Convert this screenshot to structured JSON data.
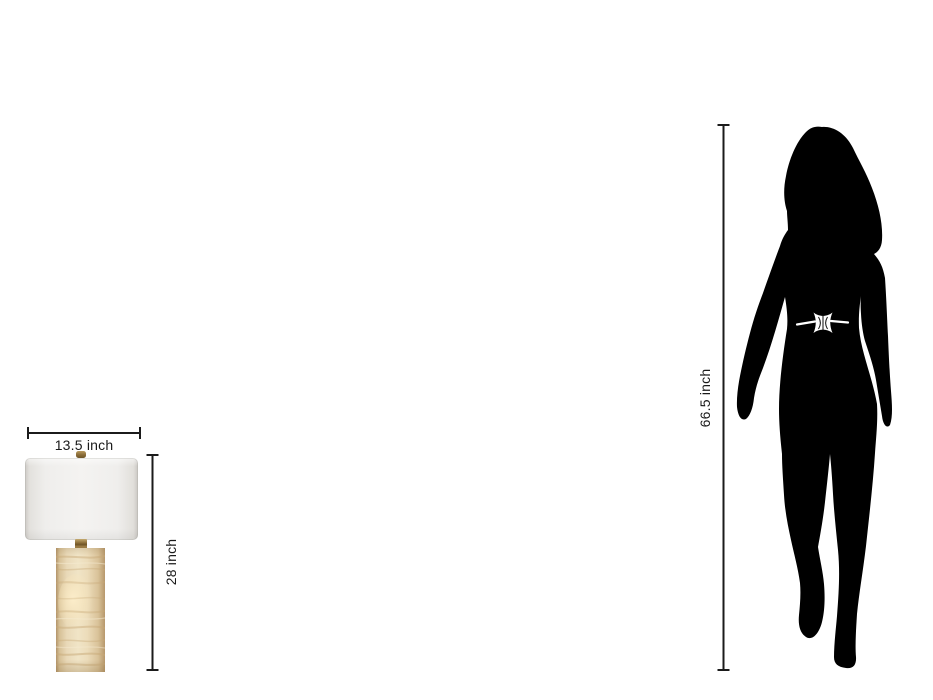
{
  "page": {
    "background_color": "#ffffff",
    "description_labels_only": true
  },
  "lamp": {
    "width_dimension": {
      "label": "13.5 inch"
    },
    "height_dimension": {
      "label": "28 inch"
    },
    "colors": {
      "shade": "#f2f1ef",
      "shade_edge": "#cac7c3",
      "brass": "#8a6c38",
      "base_cream": "#efe2c4",
      "base_tan": "#b7986c",
      "base_glow": "#fdeecb"
    }
  },
  "person": {
    "height_dimension": {
      "label": "66.5 inch"
    },
    "silhouette_color": "#000000",
    "belt_color": "#ffffff"
  },
  "dimension_style": {
    "line_color": "#1b1b1b",
    "text_color": "#1a1a1a"
  }
}
